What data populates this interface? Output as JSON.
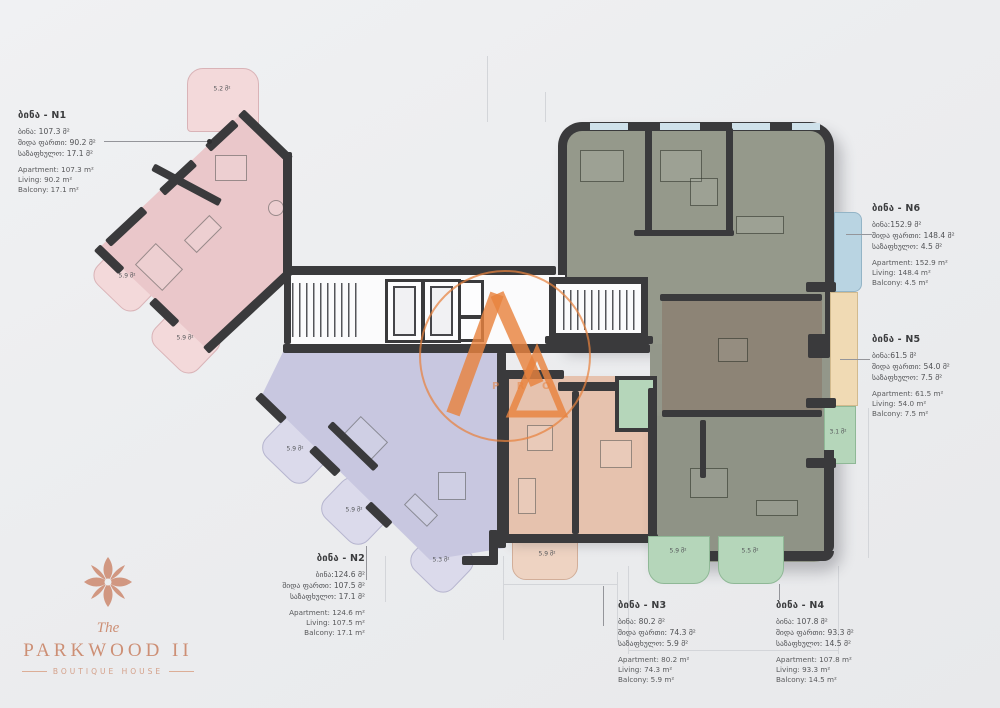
{
  "apartments": [
    {
      "id": "N1",
      "title": "ბინა - N1",
      "geo": [
        "ბინა: 107.3 მ²",
        "შიდა ფართი: 90.2 მ²",
        "საზაფხულო: 17.1 მ²"
      ],
      "eng": [
        "Apartment: 107.3 m²",
        "Living: 90.2 m²",
        "Balcony: 17.1 m²"
      ]
    },
    {
      "id": "N2",
      "title": "ბინა - N2",
      "geo": [
        "ბინა:124.6 მ²",
        "შიდა ფართი: 107.5 მ²",
        "საზაფხულო: 17.1 მ²"
      ],
      "eng": [
        "Apartment: 124.6 m²",
        "Living: 107.5 m²",
        "Balcony: 17.1 m²"
      ]
    },
    {
      "id": "N3",
      "title": "ბინა - N3",
      "geo": [
        "ბინა: 80.2 მ²",
        "შიდა ფართი: 74.3 მ²",
        "საზაფხულო: 5.9 მ²"
      ],
      "eng": [
        "Apartment: 80.2 m²",
        "Living: 74.3 m²",
        "Balcony: 5.9 m²"
      ]
    },
    {
      "id": "N4",
      "title": "ბინა - N4",
      "geo": [
        "ბინა: 107.8 მ²",
        "შიდა ფართი: 93.3 მ²",
        "საზაფხულო: 14.5 მ²"
      ],
      "eng": [
        "Apartment: 107.8 m²",
        "Living: 93.3 m²",
        "Balcony: 14.5 m²"
      ]
    },
    {
      "id": "N5",
      "title": "ბინა - N5",
      "geo": [
        "ბინა:61.5 მ²",
        "შიდა ფართი: 54.0 მ²",
        "საზაფხულო: 7.5 მ²"
      ],
      "eng": [
        "Apartment: 61.5 m²",
        "Living: 54.0 m²",
        "Balcony: 7.5 m²"
      ]
    },
    {
      "id": "N6",
      "title": "ბინა - N6",
      "geo": [
        "ბინა:152.9 მ²",
        "შიდა ფართი: 148.4 მ²",
        "საზაფხულო: 4.5 მ²"
      ],
      "eng": [
        "Apartment: 152.9 m²",
        "Living: 148.4 m²",
        "Balcony: 4.5 m²"
      ]
    }
  ],
  "balconies": {
    "n1_top": "5.2 მ²",
    "n1_a": "5.9 მ²",
    "n1_b": "5.9 მ²",
    "n2_a": "5.9 მ²",
    "n2_b": "5.9 მ²",
    "n2_c": "5.3 მ²",
    "n3_a": "5.9 მ²",
    "n4_a": "3.1 მ²",
    "n4_b": "5.9 მ²",
    "n4_c": "5.5 მ²"
  },
  "brand": {
    "prefix": "The",
    "name": "PARKWOOD II",
    "subtitle": "BOUTIQUE HOUSE"
  },
  "watermark": {
    "letters": "P R O"
  },
  "colors": {
    "wall": "#3a3a3c",
    "accent_copper": "#cd8f75",
    "watermark_orange": "#e8823e",
    "n1_pink": "#eac7ca",
    "n2_lavender": "#c8c7e0",
    "n3_peach": "#e6c2ae",
    "n4_sage": "#8f9386",
    "n5_brown": "#8d8476",
    "n6_sage": "#95998b",
    "balcony_blue": "#b9d4e2",
    "balcony_green": "#b5d6ba",
    "balcony_tan": "#f0dab4"
  }
}
